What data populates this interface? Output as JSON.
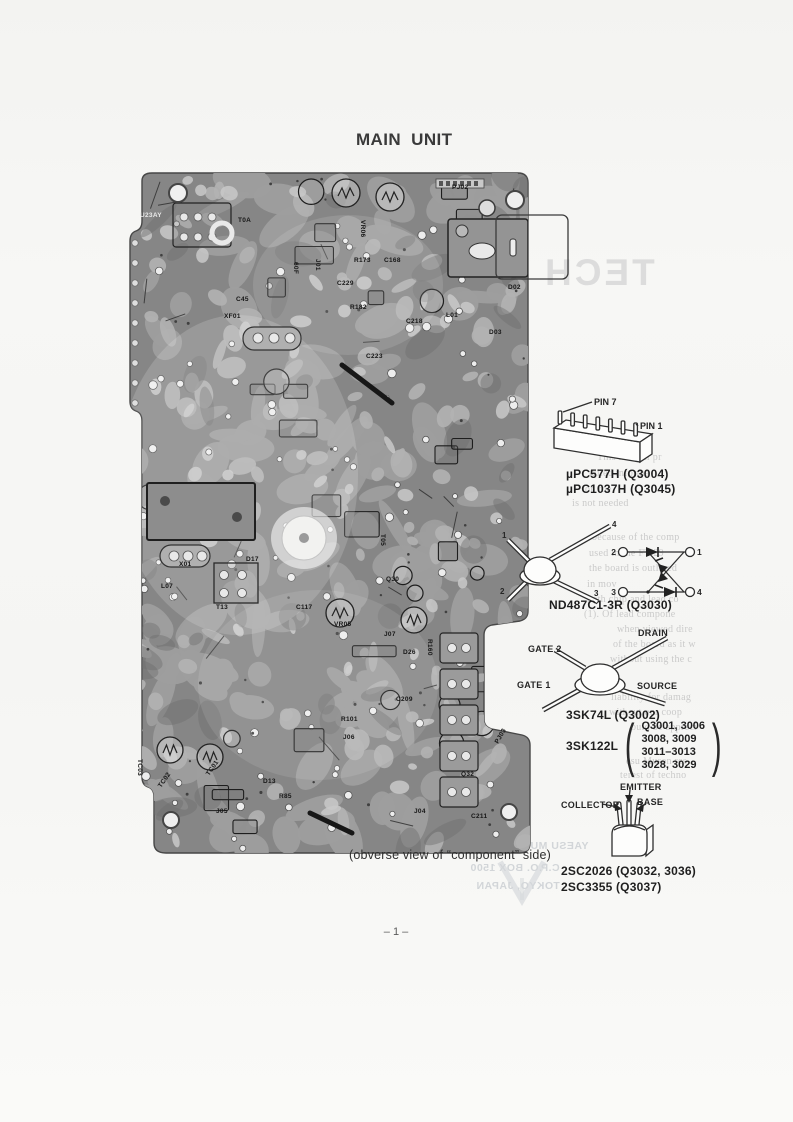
{
  "page": {
    "title": "MAIN UNIT",
    "caption": "(obverse view of “component” side)",
    "page_number": "– 1 –"
  },
  "colors": {
    "board_base": "#868686",
    "page_bg": "#f6f6f4",
    "ink": "#2b2b2b"
  },
  "board": {
    "labels": [
      {
        "t": "PJ02",
        "x": 334,
        "y": 24,
        "r": 0
      },
      {
        "t": "U23AY",
        "x": 22,
        "y": 52,
        "r": 0,
        "w": 1
      },
      {
        "t": "T0A",
        "x": 120,
        "y": 57,
        "r": 0
      },
      {
        "t": "VR06",
        "x": 243,
        "y": 55,
        "r": 90
      },
      {
        "t": "J01",
        "x": 198,
        "y": 94,
        "r": 90
      },
      {
        "t": "60F",
        "x": 176,
        "y": 97,
        "r": 90
      },
      {
        "t": "R173",
        "x": 236,
        "y": 97,
        "r": 0
      },
      {
        "t": "C168",
        "x": 266,
        "y": 97,
        "r": 0
      },
      {
        "t": "C229",
        "x": 219,
        "y": 120,
        "r": 0
      },
      {
        "t": "R182",
        "x": 232,
        "y": 144,
        "r": 0
      },
      {
        "t": "C218",
        "x": 288,
        "y": 158,
        "r": 0
      },
      {
        "t": "L01",
        "x": 328,
        "y": 152,
        "r": 0
      },
      {
        "t": "D02",
        "x": 390,
        "y": 124,
        "r": 0
      },
      {
        "t": "D03",
        "x": 371,
        "y": 169,
        "r": 0
      },
      {
        "t": "C223",
        "x": 248,
        "y": 193,
        "r": 0
      },
      {
        "t": "C45",
        "x": 118,
        "y": 136,
        "r": 0
      },
      {
        "t": "XF01",
        "x": 106,
        "y": 153,
        "r": 0
      },
      {
        "t": "X01",
        "x": 61,
        "y": 401,
        "r": 0
      },
      {
        "t": "D17",
        "x": 128,
        "y": 396,
        "r": 0
      },
      {
        "t": "L07",
        "x": 43,
        "y": 423,
        "r": 0
      },
      {
        "t": "T13",
        "x": 98,
        "y": 444,
        "r": 0
      },
      {
        "t": "C117",
        "x": 178,
        "y": 444,
        "r": 0
      },
      {
        "t": "T05",
        "x": 263,
        "y": 369,
        "r": 90
      },
      {
        "t": "Q30",
        "x": 268,
        "y": 416,
        "r": 0
      },
      {
        "t": "VR05",
        "x": 216,
        "y": 461,
        "r": 0
      },
      {
        "t": "J07",
        "x": 266,
        "y": 471,
        "r": 0
      },
      {
        "t": "D26",
        "x": 285,
        "y": 489,
        "r": 0
      },
      {
        "t": "R160",
        "x": 310,
        "y": 474,
        "r": 90
      },
      {
        "t": "C209",
        "x": 278,
        "y": 536,
        "r": 0
      },
      {
        "t": "R101",
        "x": 223,
        "y": 556,
        "r": 0
      },
      {
        "t": "J06",
        "x": 225,
        "y": 574,
        "r": 0
      },
      {
        "t": "Q32",
        "x": 343,
        "y": 611,
        "r": 0
      },
      {
        "t": "PJ03",
        "x": 380,
        "y": 579,
        "r": -60
      },
      {
        "t": "J04",
        "x": 296,
        "y": 648,
        "r": 0
      },
      {
        "t": "C211",
        "x": 353,
        "y": 653,
        "r": 0
      },
      {
        "t": "D13",
        "x": 145,
        "y": 618,
        "r": 0
      },
      {
        "t": "R85",
        "x": 161,
        "y": 633,
        "r": 0
      },
      {
        "t": "J05",
        "x": 98,
        "y": 648,
        "r": 0
      },
      {
        "t": "TC01",
        "x": 91,
        "y": 611,
        "r": -55
      },
      {
        "t": "TC02",
        "x": 43,
        "y": 623,
        "r": -55
      },
      {
        "t": "TC03",
        "x": 20,
        "y": 594,
        "r": 90
      }
    ]
  },
  "diagrams": {
    "sip": {
      "pin7_label": "PIN 7",
      "pin1_label": "PIN 1",
      "caption_line1": "µPC577H (Q3004)",
      "caption_line2": "µPC1037H (Q3045)"
    },
    "diode": {
      "pkg_pin1": "1",
      "pkg_pin2": "2",
      "pkg_pin3": "3",
      "pkg_pin4": "4",
      "sch_pin1": "1",
      "sch_pin2": "2",
      "sch_pin3": "3",
      "sch_pin4": "4",
      "caption": "ND487C1-3R (Q3030)"
    },
    "fet": {
      "drain_label": "DRAIN",
      "gate2_label": "GATE 2",
      "gate1_label": "GATE 1",
      "source_label": "SOURCE",
      "caption1": "3SK74L (Q3002)",
      "part2_label": "3SK122L",
      "paren_open": "(",
      "paren_close": ")",
      "caption2_refs": [
        "Q3001, 3006",
        "3008, 3009",
        "3011–3013",
        "3028, 3029"
      ]
    },
    "bjt": {
      "emitter_label": "EMITTER",
      "base_label": "BASE",
      "collector_label": "COLLECTOR",
      "caption1": "2SC2026 (Q3032, 3036)",
      "caption2": "2SC3355 (Q3037)"
    }
  },
  "bleedthrough": {
    "tech": "TECH",
    "right_lines": [
      {
        "x": 597,
        "y": 452,
        "t": "This manual pr"
      },
      {
        "x": 589,
        "y": 468,
        "t": "tailed informa"
      },
      {
        "x": 585,
        "y": 484,
        "t": "on the"
      },
      {
        "x": 572,
        "y": 498,
        "t": "is not needed"
      },
      {
        "x": 592,
        "y": 532,
        "t": "because of the comp"
      },
      {
        "x": 589,
        "y": 548,
        "t": "used in the FT 29"
      },
      {
        "x": 589,
        "y": 563,
        "t": "the board is outlined"
      },
      {
        "x": 587,
        "y": 579,
        "t": "in mov"
      },
      {
        "x": 587,
        "y": 594,
        "t": "both chip and lead co"
      },
      {
        "x": 584,
        "y": 609,
        "t": "(1). Of lead compone"
      },
      {
        "x": 617,
        "y": 624,
        "t": "when viewed dire"
      },
      {
        "x": 613,
        "y": 639,
        "t": "of the board as it w"
      },
      {
        "x": 610,
        "y": 654,
        "t": "without using the c"
      },
      {
        "x": 611,
        "y": 692,
        "t": "liability for damag"
      },
      {
        "x": 609,
        "y": 707,
        "t": "without our coop"
      },
      {
        "x": 631,
        "y": 722,
        "t": "ould be appreci"
      },
      {
        "x": 626,
        "y": 756,
        "t": "esu Musen res"
      },
      {
        "x": 620,
        "y": 770,
        "t": "terest of techno"
      }
    ],
    "bottom_lines": [
      {
        "x": 452,
        "y": 840,
        "t": "YAESU MUSEN CO., LTD."
      },
      {
        "x": 470,
        "y": 862,
        "t": "C.P.O. BOX 1500"
      },
      {
        "x": 476,
        "y": 880,
        "t": "TOKYO, JAPAN"
      }
    ]
  }
}
